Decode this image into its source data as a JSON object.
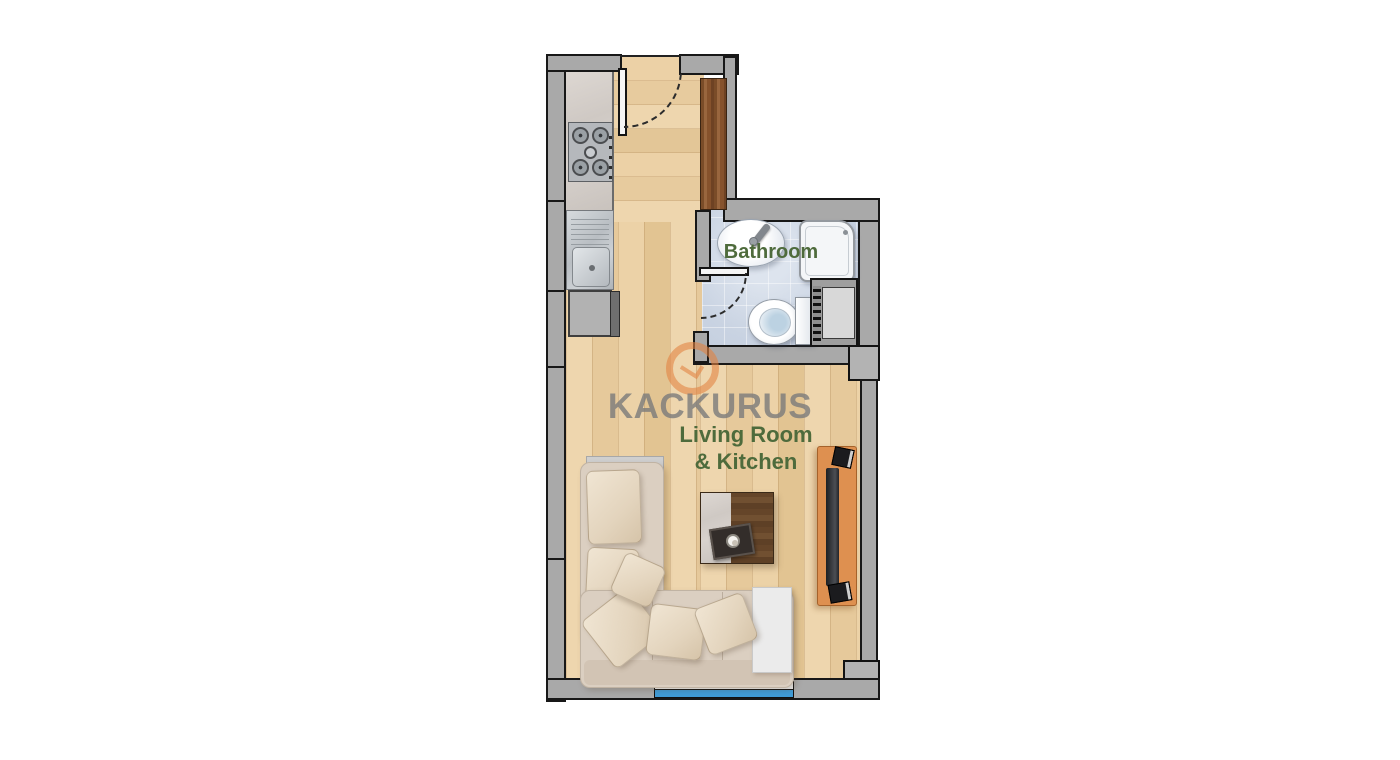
{
  "meta": {
    "type": "apartment-floor-plan"
  },
  "watermark": {
    "text": "KACKURUS",
    "logo": "kackurus-ring-logo"
  },
  "labels": {
    "bathroom": "Bathroom",
    "living_line1": "Living Room",
    "living_line2": "& Kitchen"
  },
  "colors": {
    "wall_gray": "#a9a9a9",
    "outline_black": "#181818",
    "wood_floor": "#ecd2a8",
    "closet_dark_wood": "#86522c",
    "bathroom_tile": "#c9d3e2",
    "window_glass": "#3f9cd8",
    "tv_console_wood": "#de9050",
    "sofa_beige": "#dbcfc1",
    "label_green": "#4e6b3c",
    "watermark_gray": "#7a7a7a",
    "logo_orange": "#e08348"
  },
  "fixtures": [
    "entry-door",
    "closet",
    "stove",
    "kitchen-sink",
    "kitchen-cabinet",
    "washbasin",
    "shower",
    "toilet",
    "duct-shaft",
    "bathroom-door",
    "corner-sofa",
    "pillows",
    "coffee-table",
    "side-table",
    "tv-console",
    "window"
  ]
}
